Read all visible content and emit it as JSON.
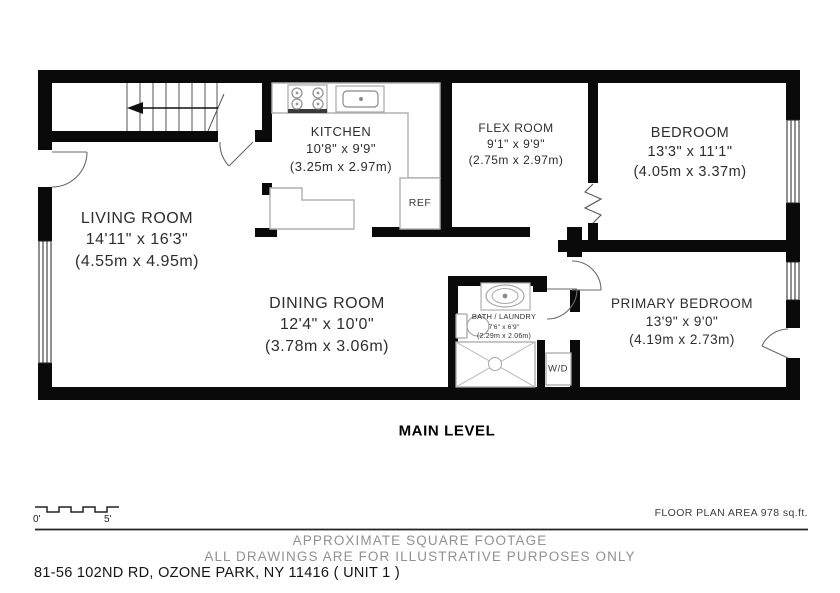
{
  "plan": {
    "level_label": "MAIN LEVEL",
    "rooms": [
      {
        "id": "living-room",
        "name": "LIVING ROOM",
        "imperial": "14'11\" x 16'3\"",
        "metric": "(4.55m x 4.95m)"
      },
      {
        "id": "kitchen",
        "name": "KITCHEN",
        "imperial": "10'8\" x 9'9\"",
        "metric": "(3.25m x 2.97m)"
      },
      {
        "id": "flex-room",
        "name": "FLEX ROOM",
        "imperial": "9'1\" x 9'9\"",
        "metric": "(2.75m x 2.97m)"
      },
      {
        "id": "bedroom",
        "name": "BEDROOM",
        "imperial": "13'3\" x 11'1\"",
        "metric": "(4.05m x 3.37m)"
      },
      {
        "id": "dining-room",
        "name": "DINING ROOM",
        "imperial": "12'4\" x 10'0\"",
        "metric": "(3.78m x 3.06m)"
      },
      {
        "id": "bath-laundry",
        "name": "BATH / LAUNDRY",
        "imperial": "7'6\" x 6'9\"",
        "metric": "(2.29m x 2.06m)"
      },
      {
        "id": "primary-bedroom",
        "name": "PRIMARY BEDROOM",
        "imperial": "13'9\" x 9'0\"",
        "metric": "(4.19m x 2.73m)"
      }
    ],
    "appliances": {
      "refrigerator": "REF",
      "washer_dryer": "W/D"
    },
    "scale_bar": {
      "start_label": "0'",
      "end_label": "5'"
    }
  },
  "footer": {
    "area_note": "FLOOR PLAN AREA 978 sq.ft.",
    "disclaimer_line1": "APPROXIMATE SQUARE FOOTAGE",
    "disclaimer_line2": "ALL DRAWINGS ARE FOR ILLUSTRATIVE PURPOSES ONLY",
    "address": "81-56 102ND RD, OZONE PARK, NY 11416 ( UNIT 1 )"
  },
  "colors": {
    "wall": "#0a0a0a",
    "fixture_stroke": "#b0b0b0",
    "muted_text": "#8f9194"
  }
}
